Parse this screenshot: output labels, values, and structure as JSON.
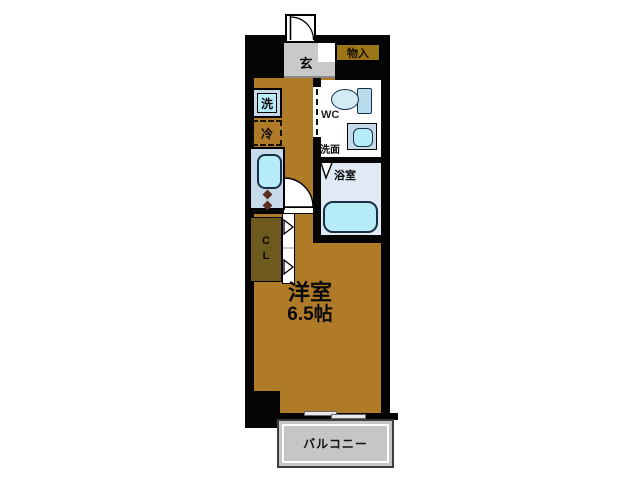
{
  "floorplan": {
    "labels": {
      "entrance": "玄",
      "storage": "物入",
      "washer": "洗",
      "fridge": "冷",
      "toilet": "WC",
      "washroom": "洗面",
      "bathroom": "浴室",
      "closet": "CL",
      "room_name": "洋室",
      "room_size": "6.5帖",
      "balcony": "バルコニー"
    },
    "colors": {
      "wall": "#050505",
      "floor": "#b07b28",
      "entrance-floor": "#c9c9c9",
      "storage-fill": "#9c7516",
      "closet-fill": "#6e591f",
      "fixture-cyan": "#b5ecf7",
      "fixture-frame": "#c7daea",
      "bathroom-floor": "#dfeaf4",
      "balcony-fill": "#c6c6c6"
    }
  }
}
